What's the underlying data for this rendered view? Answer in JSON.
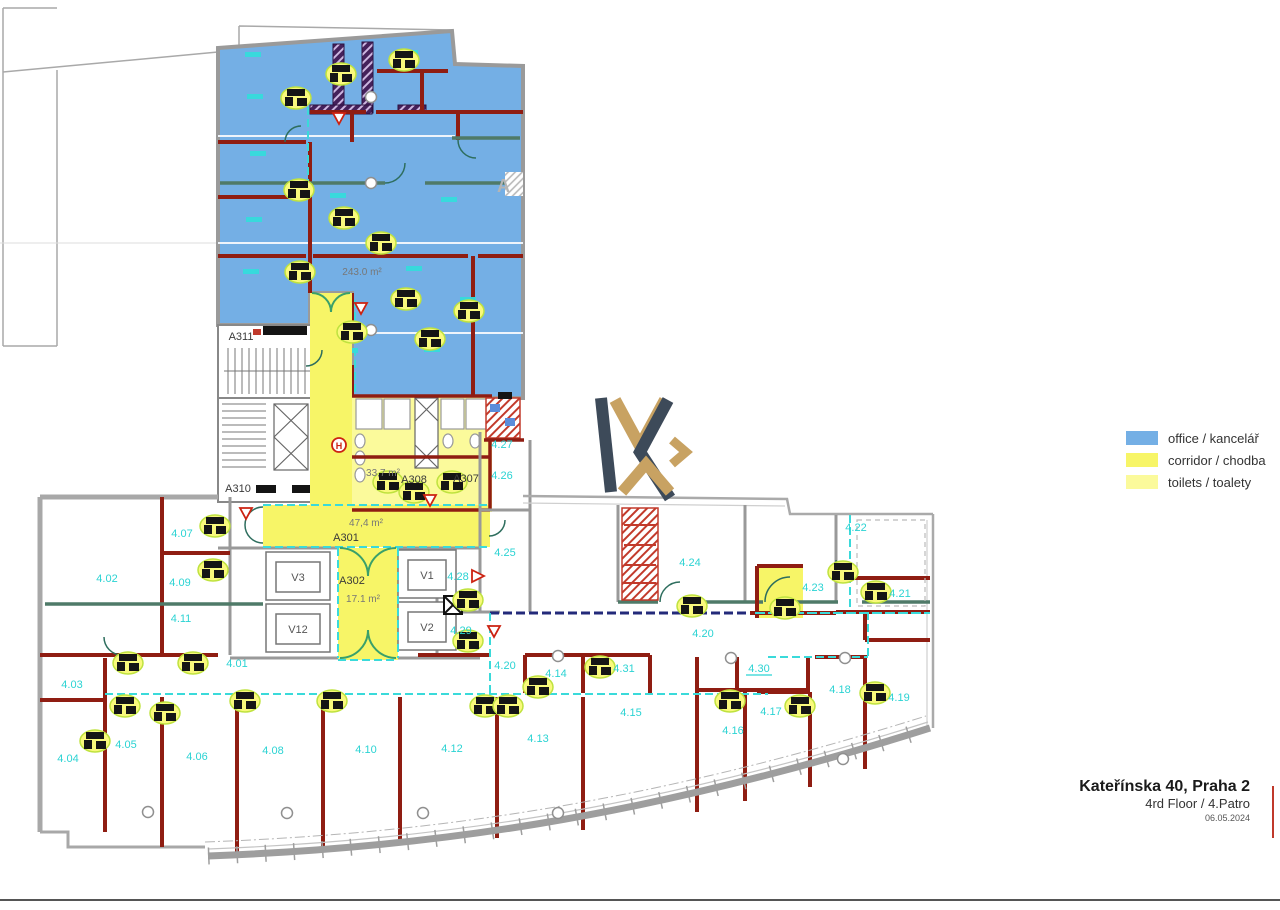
{
  "header": {
    "title": "Kateřínska 40, Praha 2",
    "floor": "4rd Floor / 4.Patro",
    "date": "06.05.2024"
  },
  "legend": {
    "items": [
      {
        "label": "office / kancelář",
        "color": "#74afe5"
      },
      {
        "label": "corridor / chodba",
        "color": "#f7f567"
      },
      {
        "label": "toilets / toalety",
        "color": "#fbfa9b"
      }
    ]
  },
  "rooms": {
    "r401": "4.01",
    "r402": "4.02",
    "r403": "4.03",
    "r404": "4.04",
    "r405": "4.05",
    "r406": "4.06",
    "r407": "4.07",
    "r408": "4.08",
    "r409": "4.09",
    "r410": "4.10",
    "r411": "4.11",
    "r412": "4.12",
    "r413": "4.13",
    "r414": "4.14",
    "r415": "4.15",
    "r416": "4.16",
    "r417": "4.17",
    "r418": "4.18",
    "r419": "4.19",
    "r420": "4.20",
    "r421": "4.21",
    "r422": "4.22",
    "r423": "4.23",
    "r424": "4.24",
    "r425": "4.25",
    "r426": "4.26",
    "r427": "4.27",
    "r428": "4.28",
    "r429": "4.29",
    "r430": "4.30",
    "r431": "4.31"
  },
  "cores": {
    "a301": "A301",
    "a302": "A302",
    "a307": "A307",
    "a308": "A308",
    "a310": "A310",
    "a311": "A311"
  },
  "lifts": {
    "v1": "V1",
    "v2": "V2",
    "v3": "V3",
    "v12": "V12"
  },
  "areas": {
    "office": "243.0 m²",
    "corridor_main": "47,4 m²",
    "corridor_lift": "17.1 m²",
    "toilets": "33,7 m²"
  },
  "symbols": {
    "hydrant": "H",
    "watermark": "A"
  }
}
